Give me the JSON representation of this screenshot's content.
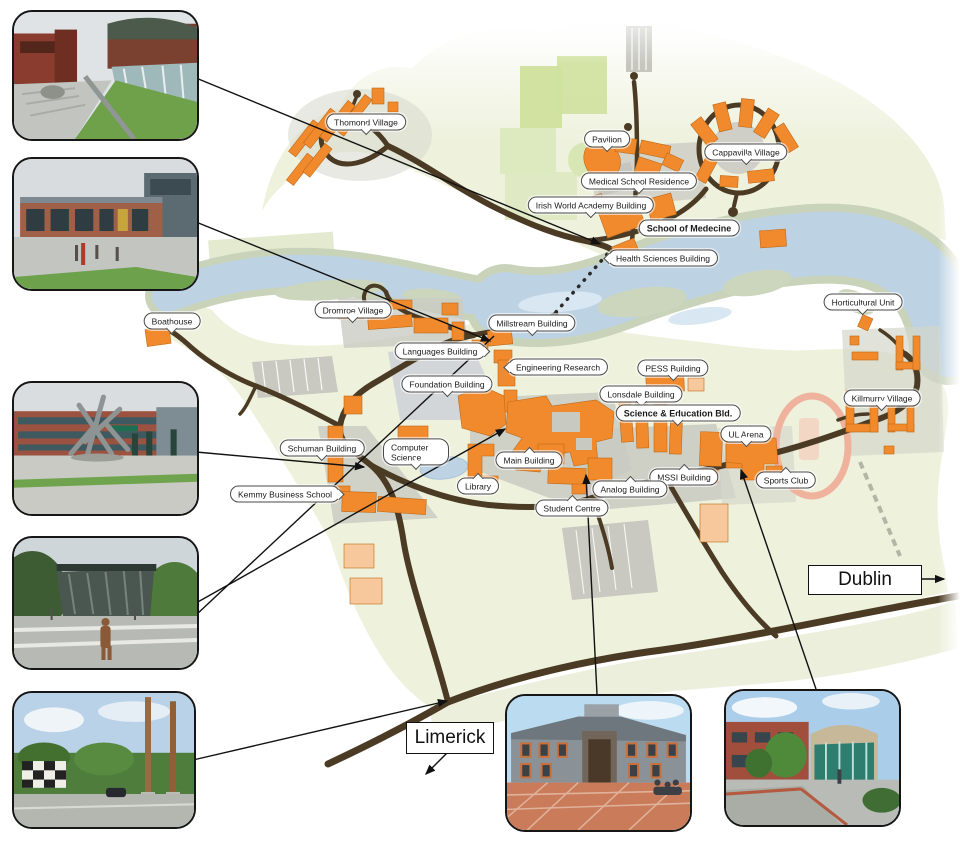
{
  "map": {
    "description": "University campus map with photo insets",
    "labels": [
      {
        "text": "Thomond Village",
        "bold": false
      },
      {
        "text": "Pavilion",
        "bold": false
      },
      {
        "text": "Cappavilla Village",
        "bold": false
      },
      {
        "text": "Medical School Residence",
        "bold": false
      },
      {
        "text": "Irish World Academy Building",
        "bold": false
      },
      {
        "text": "School of Medecine",
        "bold": true
      },
      {
        "text": "Health Sciences Building",
        "bold": false
      },
      {
        "text": "Boathouse",
        "bold": false
      },
      {
        "text": "Dromroe Village",
        "bold": false
      },
      {
        "text": "Millstream Building",
        "bold": false
      },
      {
        "text": "Languages Building",
        "bold": false
      },
      {
        "text": "Engineering Research",
        "bold": false
      },
      {
        "text": "Foundation Building",
        "bold": false
      },
      {
        "text": "PESS Building",
        "bold": false
      },
      {
        "text": "Lonsdale Building",
        "bold": false
      },
      {
        "text": "Science & Education Bld.",
        "bold": true
      },
      {
        "text": "Horticultural Unit",
        "bold": false
      },
      {
        "text": "Killmurry Village",
        "bold": false
      },
      {
        "text": "UL Arena",
        "bold": false
      },
      {
        "text": "Schuman Building",
        "bold": false
      },
      {
        "text": "Computer Science",
        "bold": false
      },
      {
        "text": "Main Building",
        "bold": false
      },
      {
        "text": "MSSI Building",
        "bold": false
      },
      {
        "text": "Sports Club",
        "bold": false
      },
      {
        "text": "Library",
        "bold": false
      },
      {
        "text": "Kemmy Business School",
        "bold": false
      },
      {
        "text": "Analog Building",
        "bold": false
      },
      {
        "text": "Student Centre",
        "bold": false
      }
    ],
    "signs": {
      "dublin": "Dublin",
      "limerick": "Limerick"
    },
    "colors": {
      "building_orange": "#f08a2d",
      "building_peach": "#f7c89c",
      "land": "#eef1dc",
      "river": "#bdd3e4",
      "river_light": "#d9e7f2",
      "bank": "#c9d3ba",
      "road": "#4b3b24",
      "grey": "#c9cac1",
      "track_pink": "#eeb29d",
      "field_green": "#d2e3a1",
      "line_black": "#111111"
    }
  }
}
